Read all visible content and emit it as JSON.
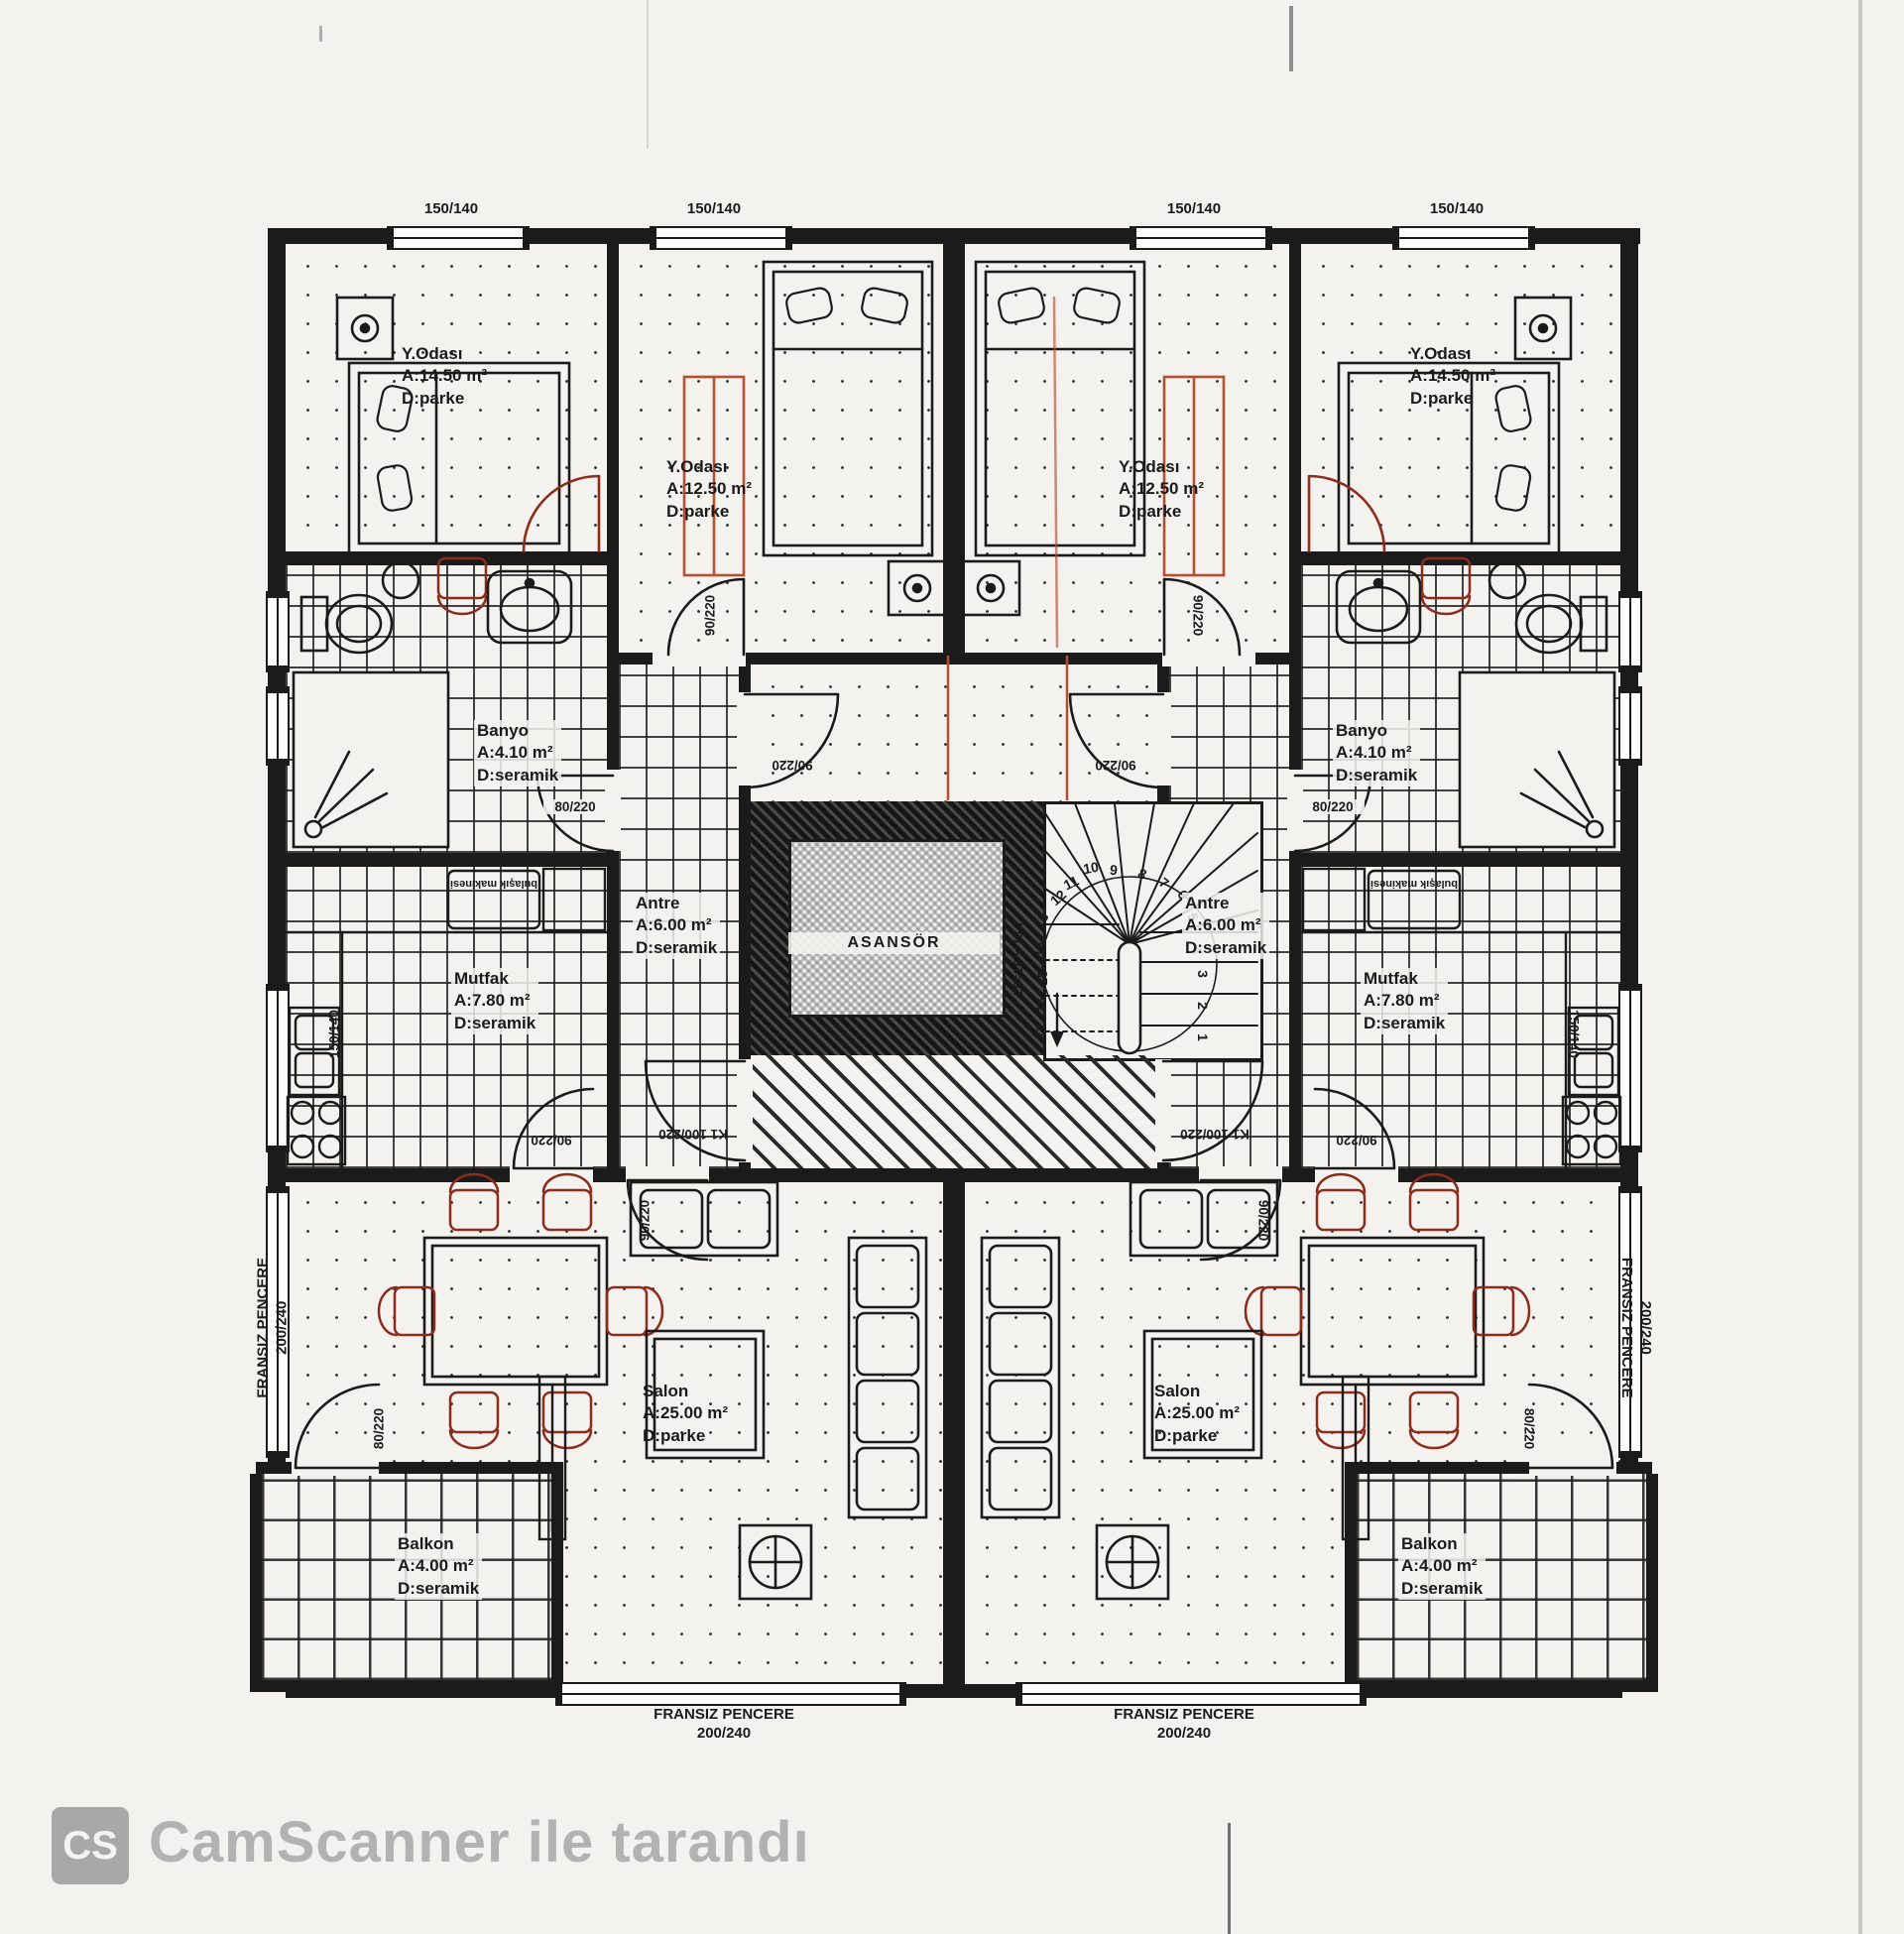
{
  "colors": {
    "paper": "#f3f2ef",
    "ink": "#1b1b1b",
    "accent_red": "#8e2c1c",
    "accent_orange": "#b5502f",
    "watermark": "#b3b2b0"
  },
  "rooms": {
    "bed_large": {
      "name": "Y.Odası",
      "area": "A:14.50 m²",
      "floor": "D:parke"
    },
    "bed_small": {
      "name": "Y.Odası",
      "area": "A:12.50 m²",
      "floor": "D:parke"
    },
    "banyo": {
      "name": "Banyo",
      "area": "A:4.10 m²",
      "floor": "D:seramik"
    },
    "mutfak": {
      "name": "Mutfak",
      "area": "A:7.80 m²",
      "floor": "D:seramik"
    },
    "antre": {
      "name": "Antre",
      "area": "A:6.00 m²",
      "floor": "D:seramik"
    },
    "salon": {
      "name": "Salon",
      "area": "A:25.00 m²",
      "floor": "D:parke"
    },
    "balkon": {
      "name": "Balkon",
      "area": "A:4.00 m²",
      "floor": "D:seramik"
    },
    "asansor": {
      "name": "ASANSÖR"
    }
  },
  "windows": {
    "top": "150/140",
    "side_kitchen": "150/140",
    "french_line1": "FRANSIZ PENCERE",
    "french_line2": "200/240"
  },
  "doors": {
    "interior": "90/220",
    "bath": "80/220",
    "entry": "K1 100/220"
  },
  "appliances": {
    "dishwasher": "bulaşık makinesi"
  },
  "stair": {
    "note": "28=18 x 15,7",
    "numbers": [
      "1",
      "2",
      "3",
      "4",
      "5",
      "6",
      "7",
      "8",
      "9",
      "10",
      "11",
      "12",
      "13",
      "14",
      "15",
      "16",
      "17"
    ]
  },
  "watermark": {
    "logo": "CS",
    "text": "CamScanner ile tarandı"
  }
}
